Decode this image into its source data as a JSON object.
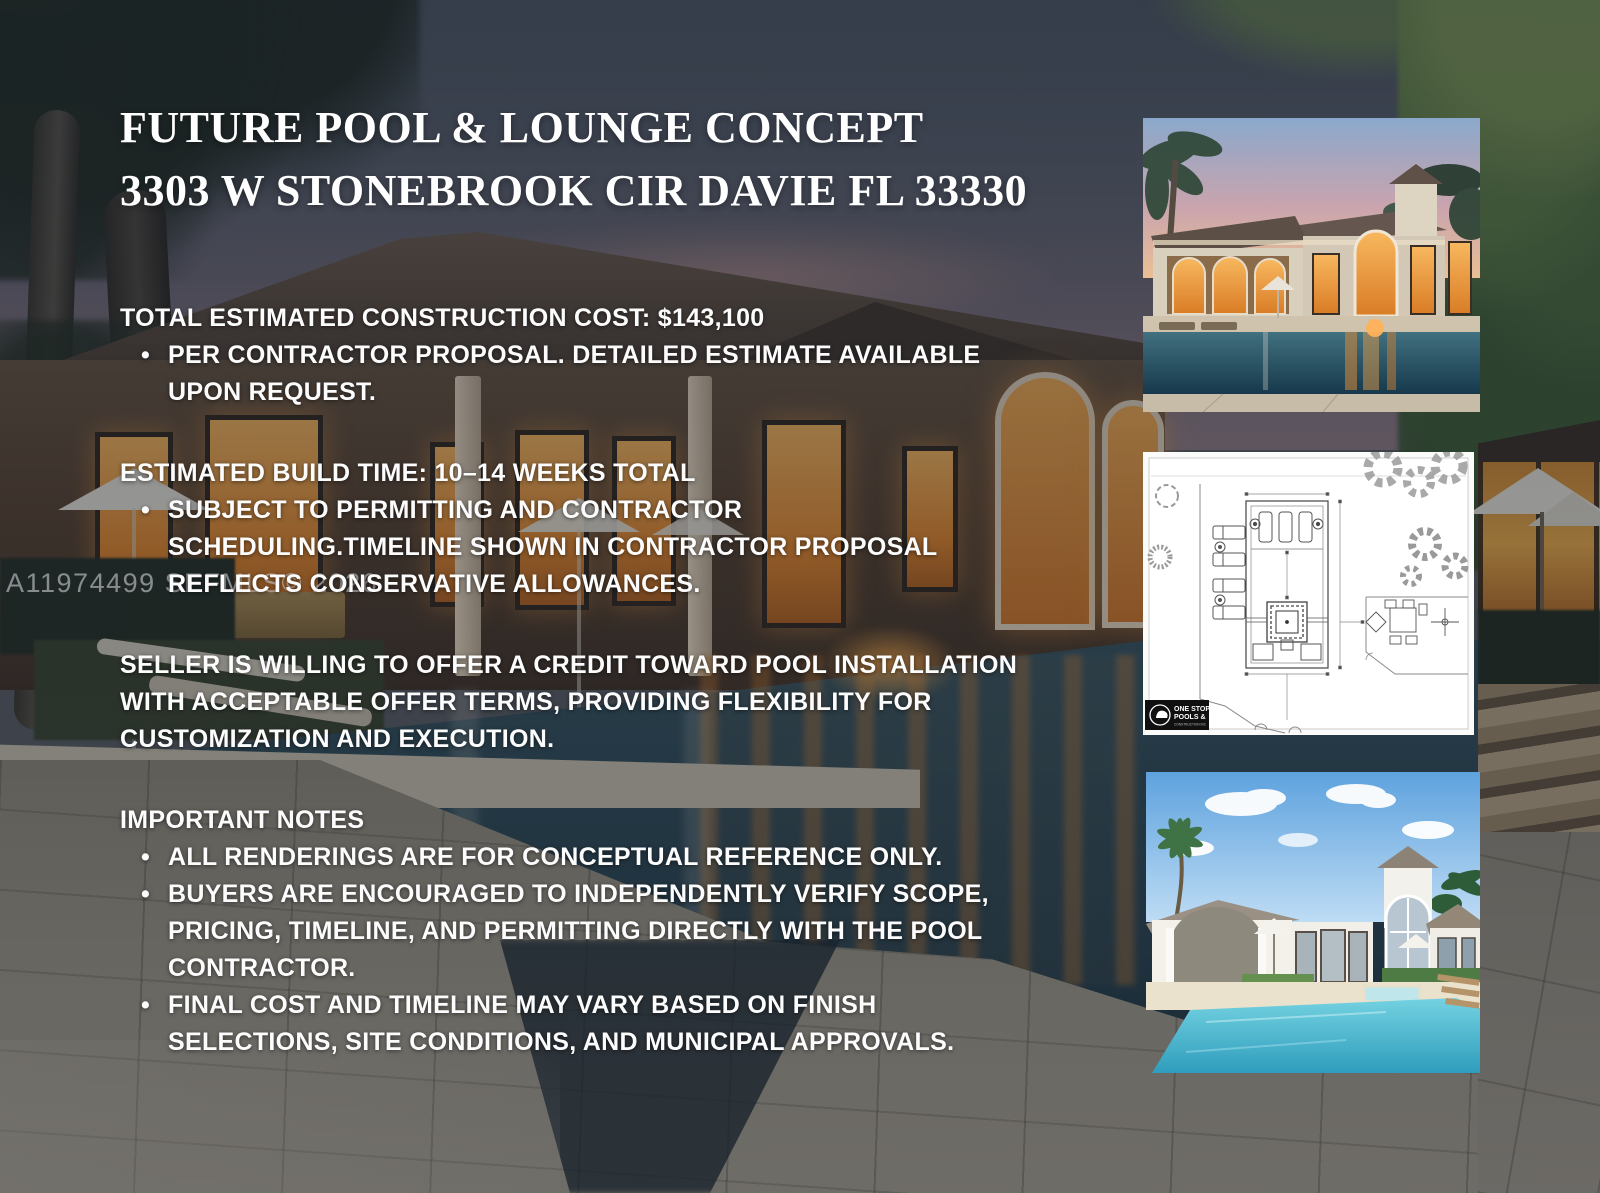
{
  "flyer": {
    "title": {
      "line1": "FUTURE POOL & LOUNGE CONCEPT",
      "line2": "3303 W STONEBROOK CIR DAVIE FL 33330"
    },
    "watermark": "A11974499 SEFMLS© 2026",
    "sections": {
      "cost": {
        "heading": "TOTAL ESTIMATED CONSTRUCTION COST: $143,100",
        "bullets": [
          "PER CONTRACTOR PROPOSAL. DETAILED ESTIMATE AVAILABLE UPON REQUEST."
        ]
      },
      "build": {
        "heading": "ESTIMATED BUILD TIME: 10–14 WEEKS TOTAL",
        "bullets": [
          "SUBJECT TO PERMITTING AND CONTRACTOR SCHEDULING.TIMELINE SHOWN IN CONTRACTOR PROPOSAL REFLECTS CONSERVATIVE ALLOWANCES."
        ]
      },
      "seller": {
        "paragraph": "SELLER IS WILLING TO OFFER A CREDIT TOWARD POOL INSTALLATION WITH ACCEPTABLE OFFER TERMS, PROVIDING FLEXIBILITY FOR CUSTOMIZATION AND EXECUTION."
      },
      "notes": {
        "heading": "IMPORTANT NOTES",
        "bullets": [
          "ALL RENDERINGS ARE FOR CONCEPTUAL REFERENCE ONLY.",
          "BUYERS ARE ENCOURAGED TO INDEPENDENTLY VERIFY SCOPE, PRICING, TIMELINE, AND PERMITTING DIRECTLY WITH THE POOL CONTRACTOR.",
          "FINAL COST AND TIMELINE MAY VARY BASED ON FINISH SELECTIONS, SITE CONDITIONS, AND MUNICIPAL APPROVALS."
        ]
      }
    },
    "plan_logo": {
      "line1": "ONE STOP",
      "line2": "POOLS &",
      "line3": "CONSTRUCTION INC"
    },
    "colors": {
      "glow_orange": "#e8923a",
      "pool_teal": "#2f4c59",
      "dusk_sky": "#5a6272",
      "day_pool": "#55c2d8",
      "paver_gray": "#9e978a",
      "blueprint_line": "#555555",
      "logo_black": "#101010"
    }
  }
}
